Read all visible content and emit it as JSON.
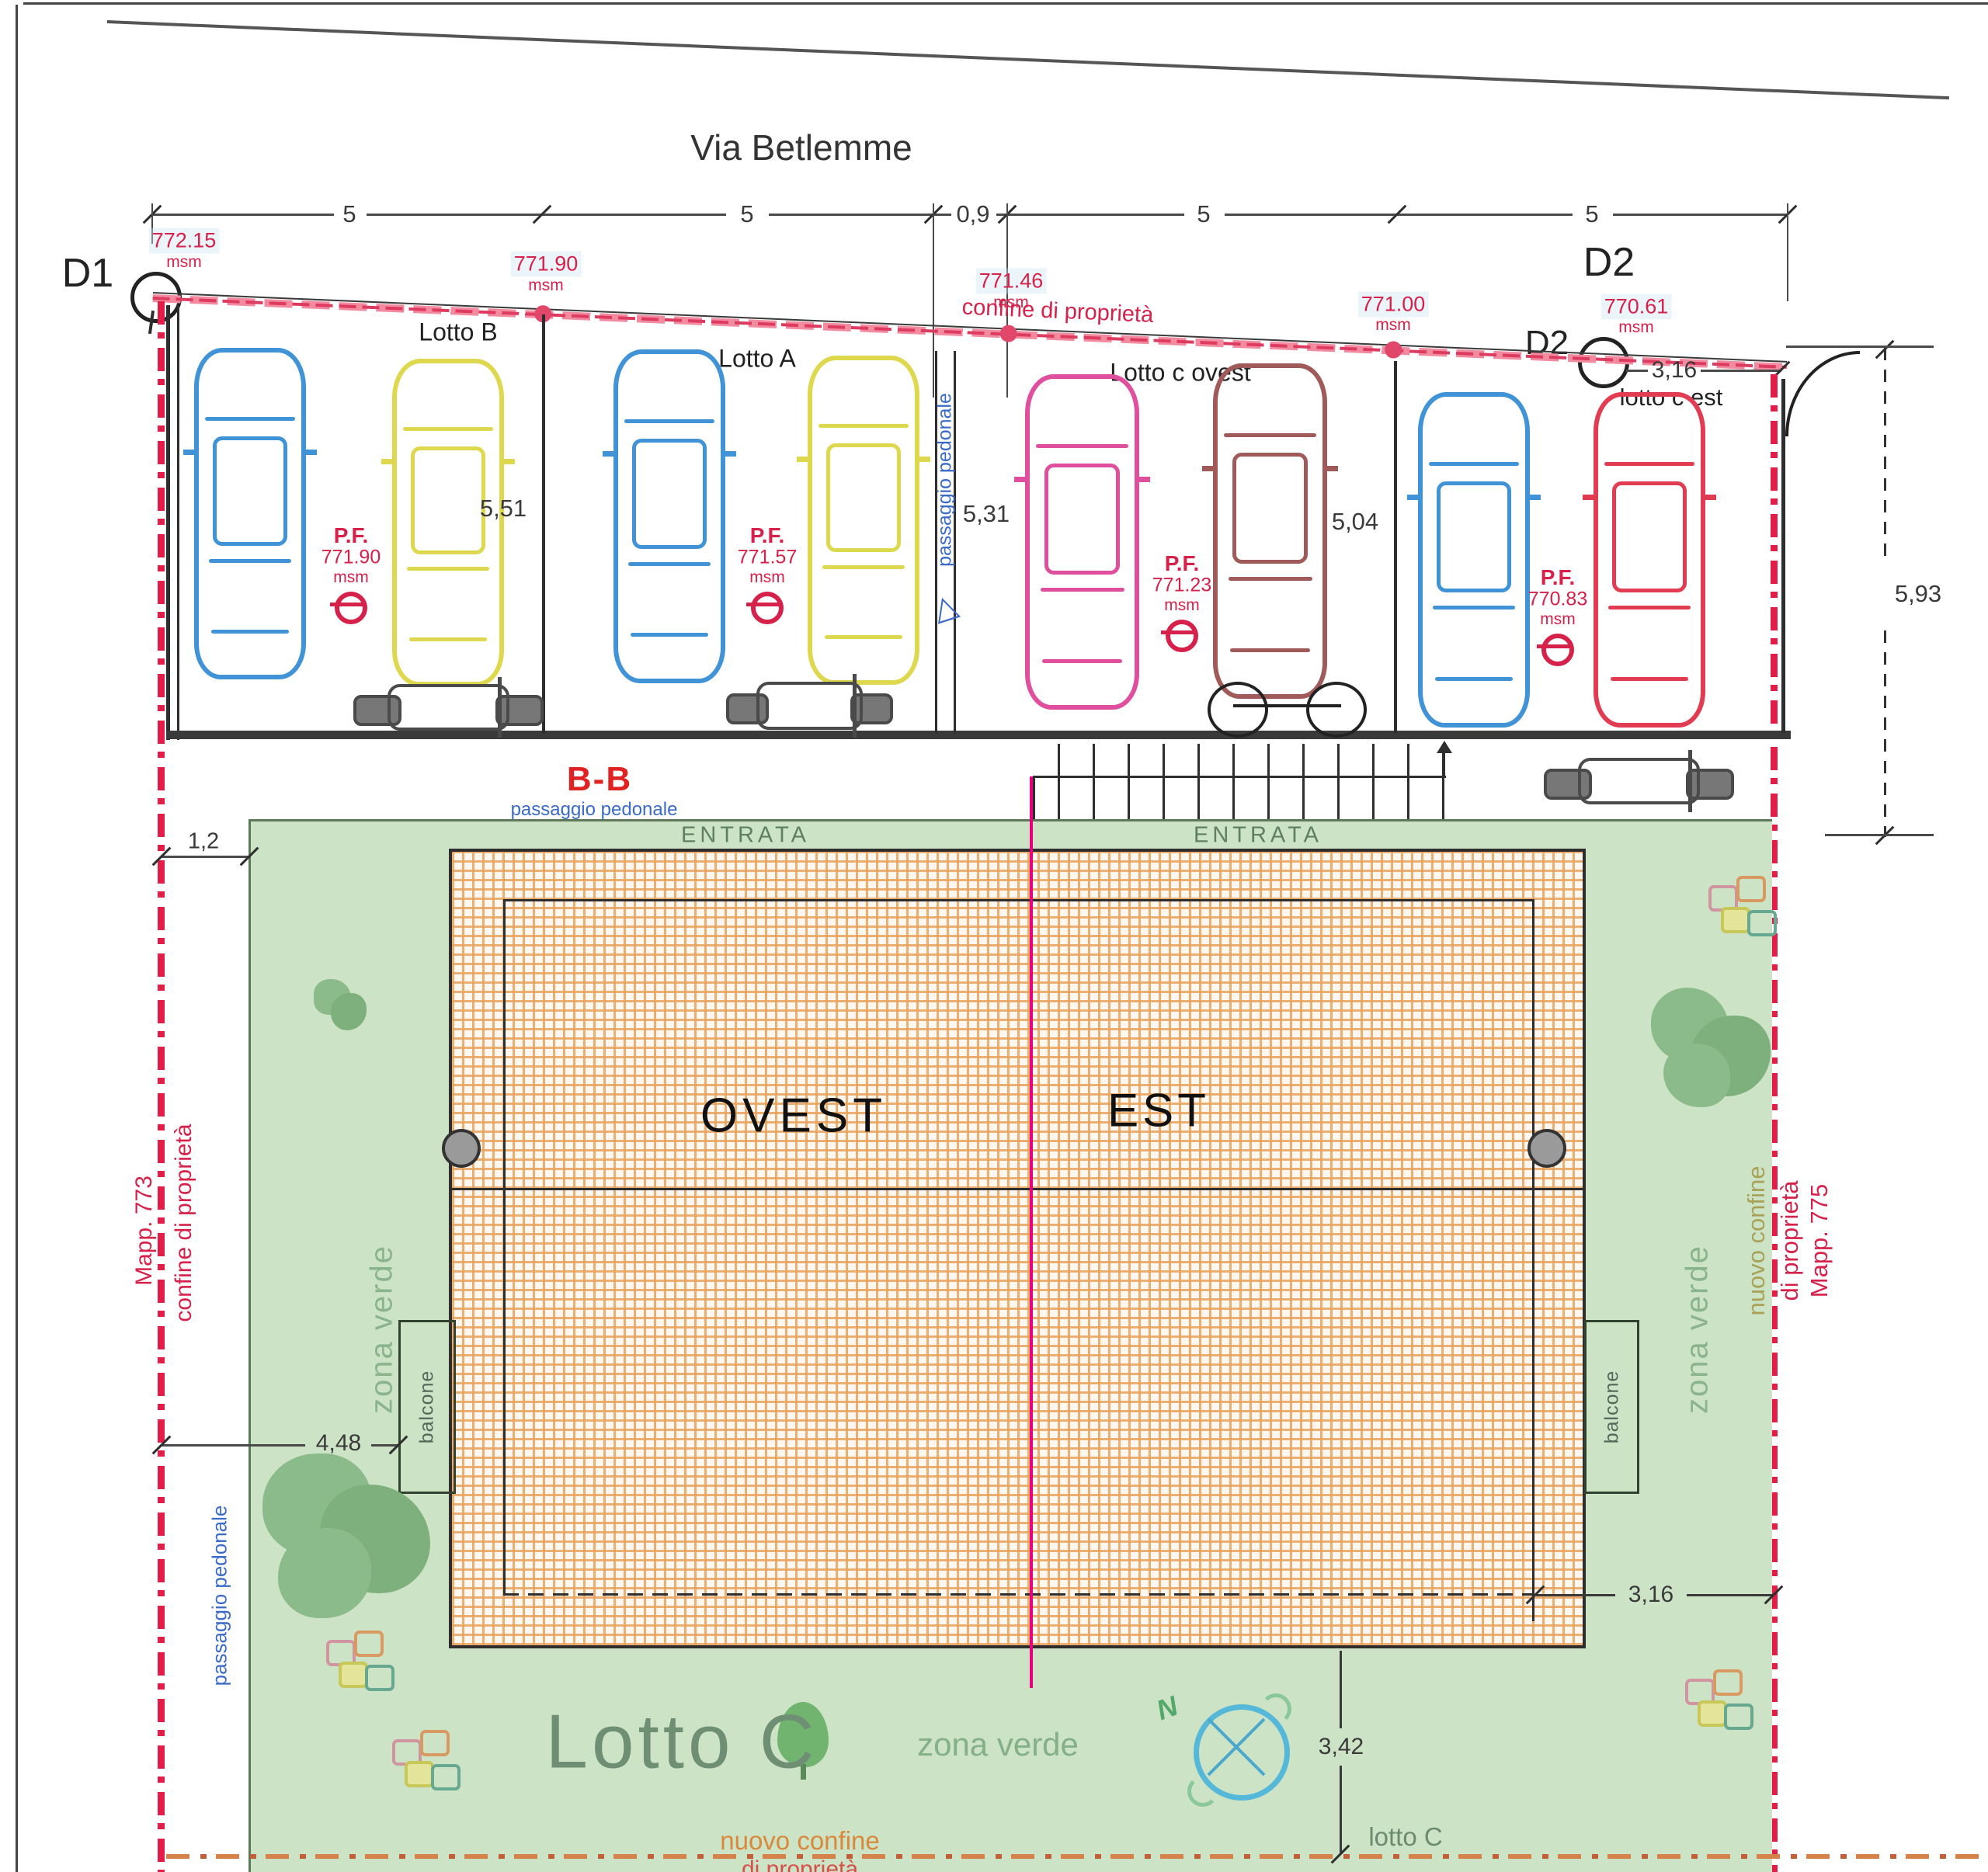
{
  "street": {
    "name": "Via Betlemme"
  },
  "top_dims": [
    "5",
    "5",
    "0,9",
    "5",
    "5"
  ],
  "markers": {
    "d1": "D1",
    "d2_big": "D2",
    "d2_small": "D2"
  },
  "boundary": {
    "confine_label": "confine di proprietà",
    "elevations": [
      {
        "value": "772.15",
        "unit": "msm"
      },
      {
        "value": "771.90",
        "unit": "msm"
      },
      {
        "value": "771.46",
        "unit": "msm"
      },
      {
        "value": "771.00",
        "unit": "msm"
      },
      {
        "value": "770.61",
        "unit": "msm"
      }
    ]
  },
  "lots": [
    {
      "name": "Lotto B",
      "pf_label": "P.F.",
      "pf_value": "771.90",
      "pf_unit": "msm",
      "depth": "5,51"
    },
    {
      "name": "Lotto A",
      "pf_label": "P.F.",
      "pf_value": "771.57",
      "pf_unit": "msm",
      "depth": "5,31"
    },
    {
      "name": "Lotto c ovest",
      "pf_label": "P.F.",
      "pf_value": "771.23",
      "pf_unit": "msm",
      "depth": "5,04"
    },
    {
      "name": "lotto c est",
      "pf_label": "P.F.",
      "pf_value": "770.83",
      "pf_unit": "msm",
      "depth": "5,93"
    }
  ],
  "dimensions": {
    "d316_top": "3,16",
    "d12": "1,2",
    "d448": "4,48",
    "d342": "3,42",
    "d316_bottom": "3,16"
  },
  "corridor": {
    "label": "passaggio pedonale"
  },
  "section_bb": {
    "label": "B-B",
    "sublabel": "passaggio pedonale"
  },
  "building": {
    "entrata_left": "ENTRATA",
    "entrata_right": "ENTRATA",
    "west": "OVEST",
    "east": "EST",
    "balcone_left": "balcone",
    "balcone_right": "balcone"
  },
  "green": {
    "zona_verde_left": "zona verde",
    "zona_verde_right": "zona verde",
    "zona_verde_bottom": "zona verde",
    "lotto_c_title": "Lotto C",
    "lotto_c_small": "lotto C",
    "nuovo_confine": "nuovo confine",
    "nuovo_confine_2": "di proprietà"
  },
  "left_border": {
    "confine": "confine di proprietà",
    "mapp": "Mapp. 773",
    "passaggio": "passaggio pedonale"
  },
  "right_border": {
    "nuovo_confine": "nuovo confine",
    "di_proprieta": "di proprietà",
    "mapp": "Mapp. 775"
  },
  "compass": {
    "north": "N"
  },
  "colors": {
    "property_red": "#d6214b",
    "green_zone": "#cde3c5",
    "brick_orange": "#e8a25c",
    "center_line_magenta": "#e8007e",
    "car_blue": "#3f93d6",
    "car_yellow": "#ded84e",
    "car_magenta": "#df4f9e",
    "car_maroon": "#a05a5a",
    "car_red": "#e23c52"
  }
}
